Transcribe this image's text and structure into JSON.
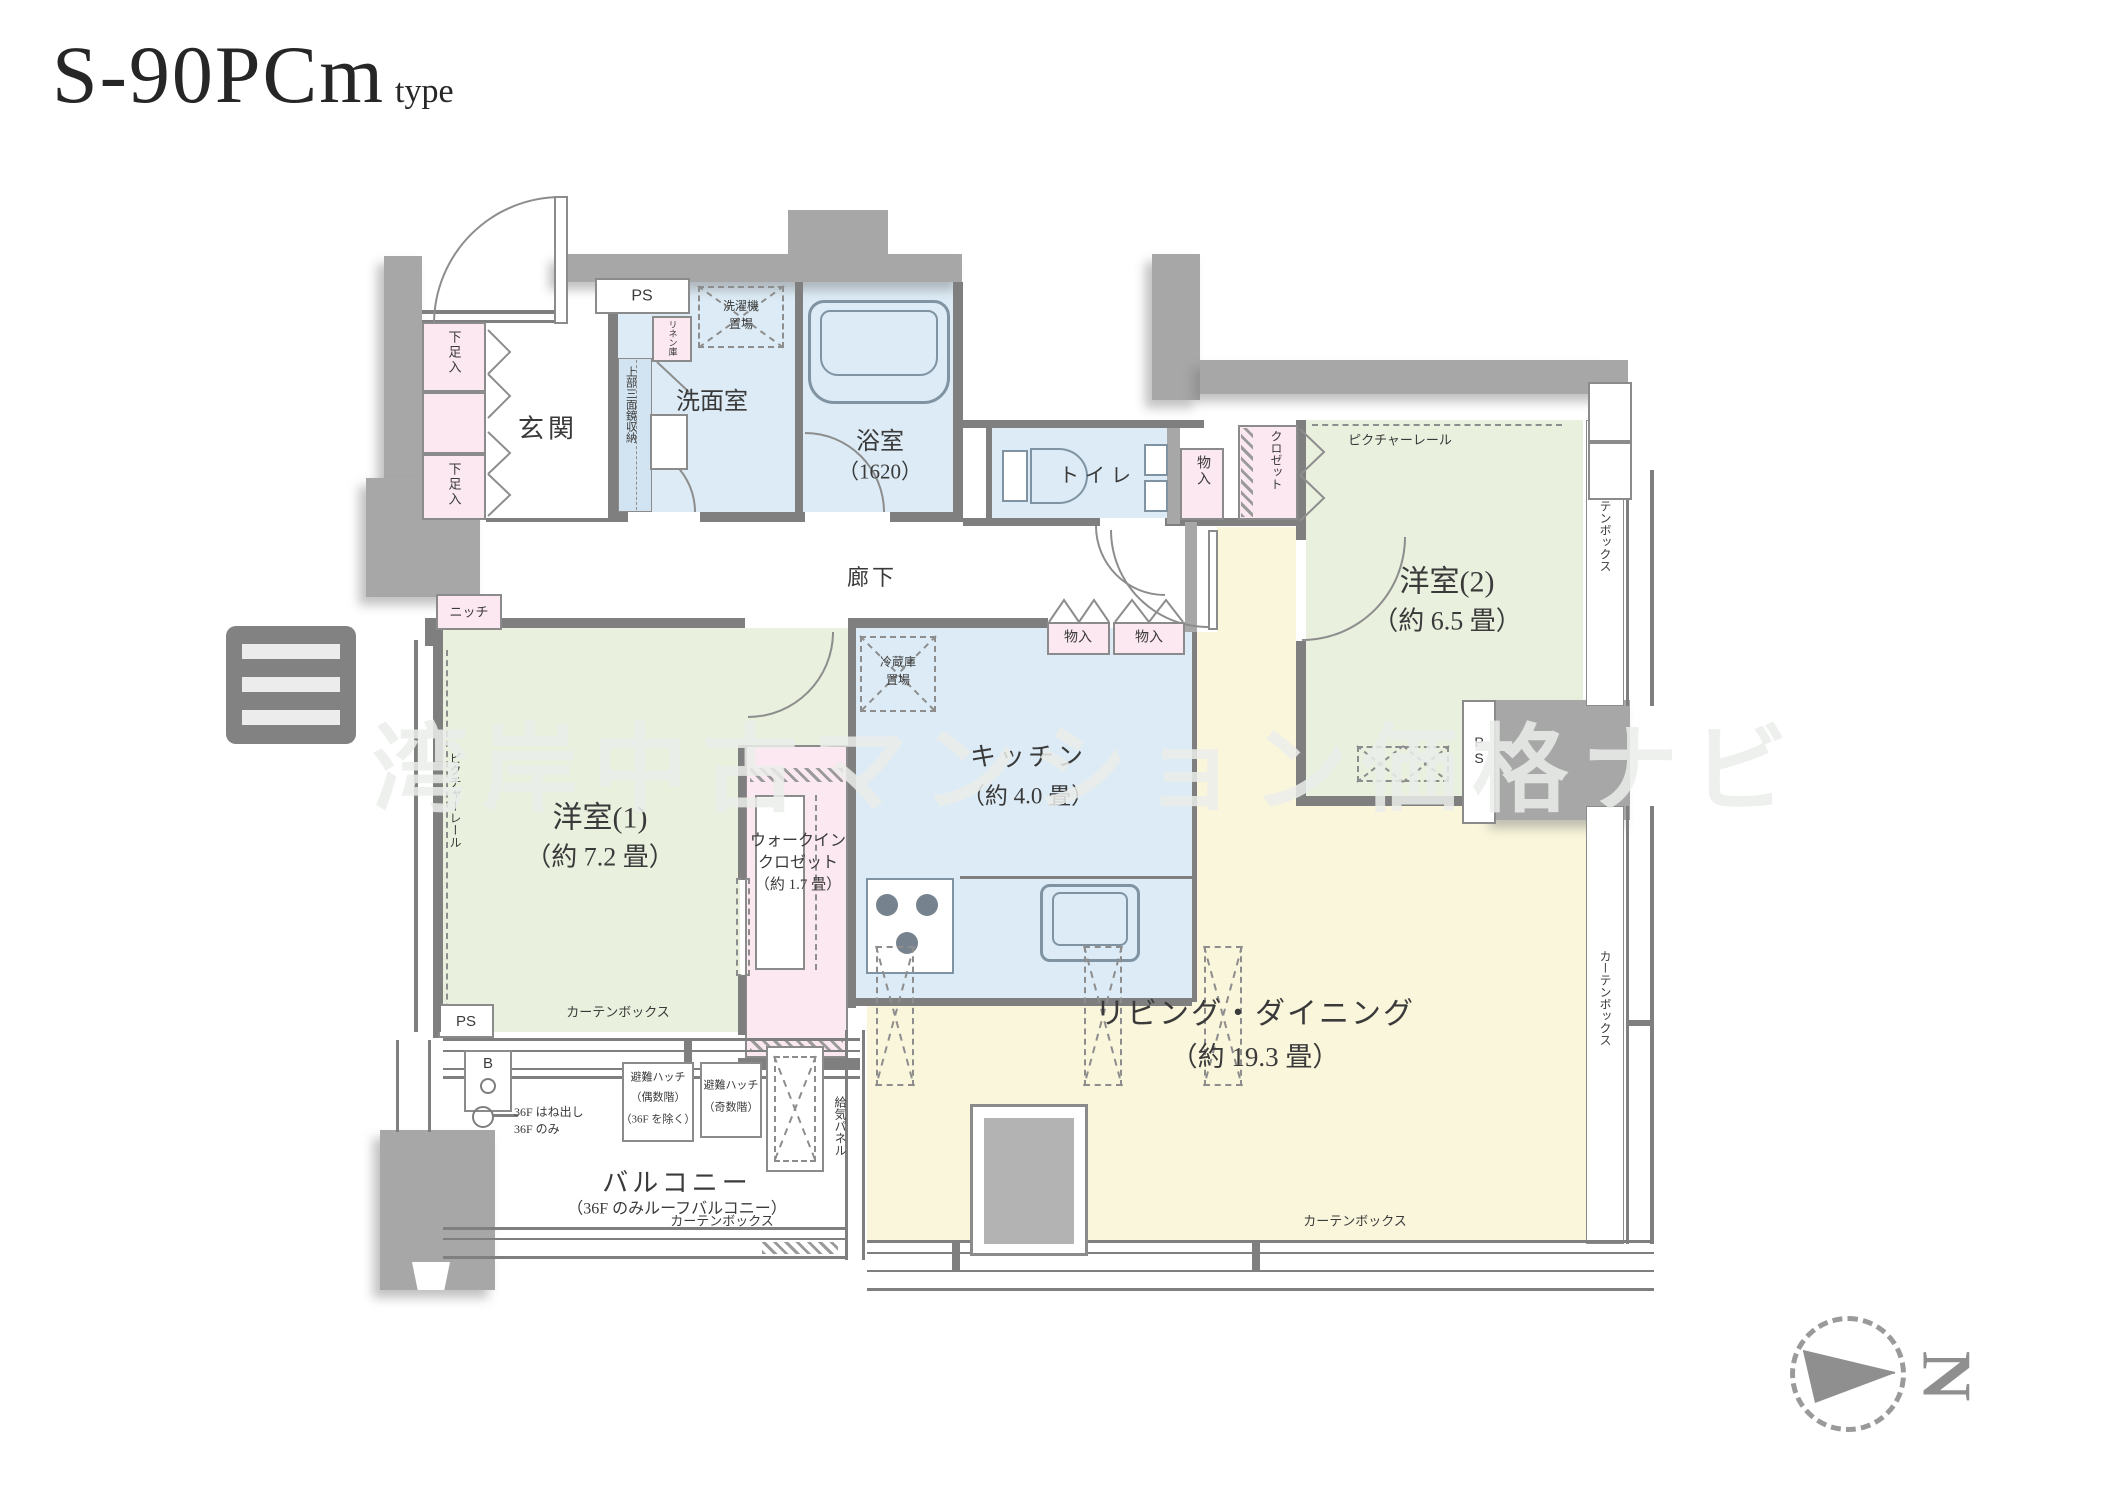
{
  "title": {
    "main": "S-90PCm",
    "suffix": "type"
  },
  "watermark": {
    "text": "湾岸中古マンション価格ナビ"
  },
  "compass": {
    "north": "N"
  },
  "rooms": {
    "genkan": "玄関",
    "corridor": "廊下",
    "washroom": "洗面室",
    "bath": "浴室",
    "bath_size": "（1620）",
    "toilet": "トイレ",
    "kitchen": "キッチン",
    "kitchen_size": "（約 4.0 畳）",
    "bedroom1": "洋室(1)",
    "bedroom1_size": "（約 7.2 畳）",
    "bedroom2": "洋室(2)",
    "bedroom2_size": "（約 6.5 畳）",
    "living": "リビング・ダイニング",
    "living_size": "（約 19.3 畳）",
    "wic1": "ウォークイン",
    "wic2": "クロゼット",
    "wic3": "（約 1.7 畳）",
    "balcony": "バルコニー",
    "balcony_note": "（36F のみルーフバルコニー）"
  },
  "storage": {
    "shoes": "下足入",
    "linen": "リネン庫",
    "mirror": "上部三面鏡収納",
    "washer1": "洗濯機",
    "washer2": "置場",
    "fridge1": "冷蔵庫",
    "fridge2": "置場",
    "closet": "クロゼット",
    "monoire": "物入",
    "niche": "ニッチ"
  },
  "labels": {
    "ps": "PS",
    "picture_rail": "ピクチャーレール",
    "curtain_box": "カーテンボックス",
    "supply_panel": "給気パネル",
    "hatch_even1": "避難ハッチ",
    "hatch_even2": "（偶数階）",
    "hatch_even3": "（36F を除く）",
    "hatch_odd1": "避難ハッチ",
    "hatch_odd2": "（奇数階）",
    "f36a": "36F はね出し",
    "f36b": "36F のみ",
    "b_mark": "B"
  }
}
